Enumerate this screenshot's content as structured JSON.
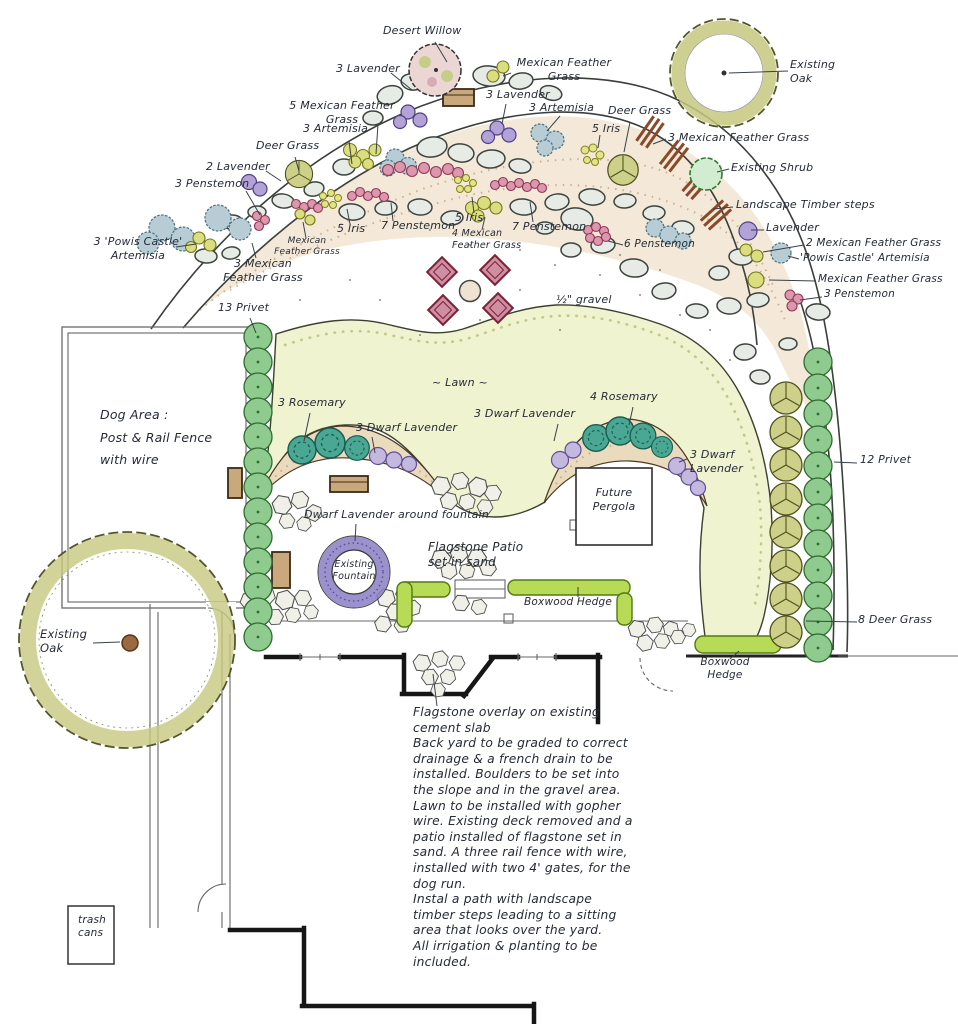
{
  "palette": {
    "paper": "#ffffff",
    "ink": "#252b36",
    "lawn": "#eff3cf",
    "bed": "#f4e9d8",
    "berm": "#eadabe",
    "privet": "#8fcb8f",
    "deergrass": "#ccd089",
    "rosemary": "#49a793",
    "lavender": "#b3a2d6",
    "dwarflavender": "#c4b8de",
    "penstemon": "#dc96ae",
    "mfgrass": "#dade7e",
    "artemisia": "#b7ccd4",
    "iris": "#e3e388",
    "boxwood": "#b7da57",
    "oak": "#c6c87e",
    "timber": "#8a4a2a",
    "chair": "#cf8fa3",
    "fountain": "#8a7fc4",
    "stone": "#e7ebe5"
  },
  "labels": {
    "desert_willow": "Desert Willow",
    "lavender3_top": "3 Lavender",
    "mfg_top_right": "Mexican Feather\nGrass",
    "lavender3_mid": "3 Lavender",
    "artemisia3_right": "3 Artemisia",
    "mfg5": "5 Mexican Feather\nGrass",
    "artemisia3_left": "3 Artemisia",
    "deer_grass_left": "Deer Grass",
    "lavender2": "2 Lavender",
    "penstemon3_left": "3 Penstemon",
    "powis_left": "3 'Powis Castle'\nArtemisia",
    "mfg3_left": "3 Mexican\nFeather Grass",
    "mfg_small": "Mexican\nFeather Grass",
    "iris5_left": "5 Iris",
    "penstemon7_left": "7 Penstemon",
    "iris5_mid": "5 Iris",
    "mfg4": "4 Mexican\nFeather Grass",
    "penstemon7_mid": "7 Penstemon",
    "penstemon6": "6 Penstemon",
    "gravel": "½\" gravel",
    "deer_grass_top": "Deer Grass",
    "iris5_top": "5 Iris",
    "mfg3_right": "3 Mexican Feather Grass",
    "existing_oak_tr": "Existing\nOak",
    "existing_shrub": "Existing Shrub",
    "timber_steps": "Landscape Timber steps",
    "lavender1": "Lavender",
    "mfg2_right": "2 Mexican Feather Grass",
    "powis_right": "'Powis Castle' Artemisia",
    "mfg_right": "Mexican Feather Grass",
    "penstemon3_right": "3 Penstemon",
    "privet13": "13 Privet",
    "dog_area": "Dog Area :\nPost & Rail Fence\nwith wire",
    "lawn": "~ Lawn ~",
    "rosemary3": "3 Rosemary",
    "dwarf_lav3_a": "3 Dwarf Lavender",
    "dwarf_lav3_b": "3 Dwarf Lavender",
    "rosemary4": "4 Rosemary",
    "dwarf_lav3_c": "3 Dwarf\nLavender",
    "privet12": "12 Privet",
    "future_pergola": "Future\nPergola",
    "dwarf_lav_fountain": "Dwarf Lavender around fountain",
    "existing_fountain": "Existing\nFountain",
    "flagstone_patio": "Flagstone Patio\nset in sand",
    "boxwood_a": "Boxwood Hedge",
    "deer_grass8": "8 Deer Grass",
    "boxwood_b": "Boxwood\nHedge",
    "existing_oak_bl": "Existing\nOak",
    "trash": "trash\ncans",
    "notes": "Flagstone overlay on existing\ncement slab\nBack yard to be graded to correct\ndrainage & a french drain to be\ninstalled. Boulders to be set into\nthe slope and in the gravel area.\nLawn to be installed with gopher\nwire. Existing deck removed and a\npatio installed of flagstone set in\nsand. A three rail fence with wire,\ninstalled with two 4' gates, for the\ndog run.\nInstal a path with landscape\ntimber steps leading to a sitting\narea that looks over the yard.\nAll irrigation & planting to be\nincluded."
  }
}
